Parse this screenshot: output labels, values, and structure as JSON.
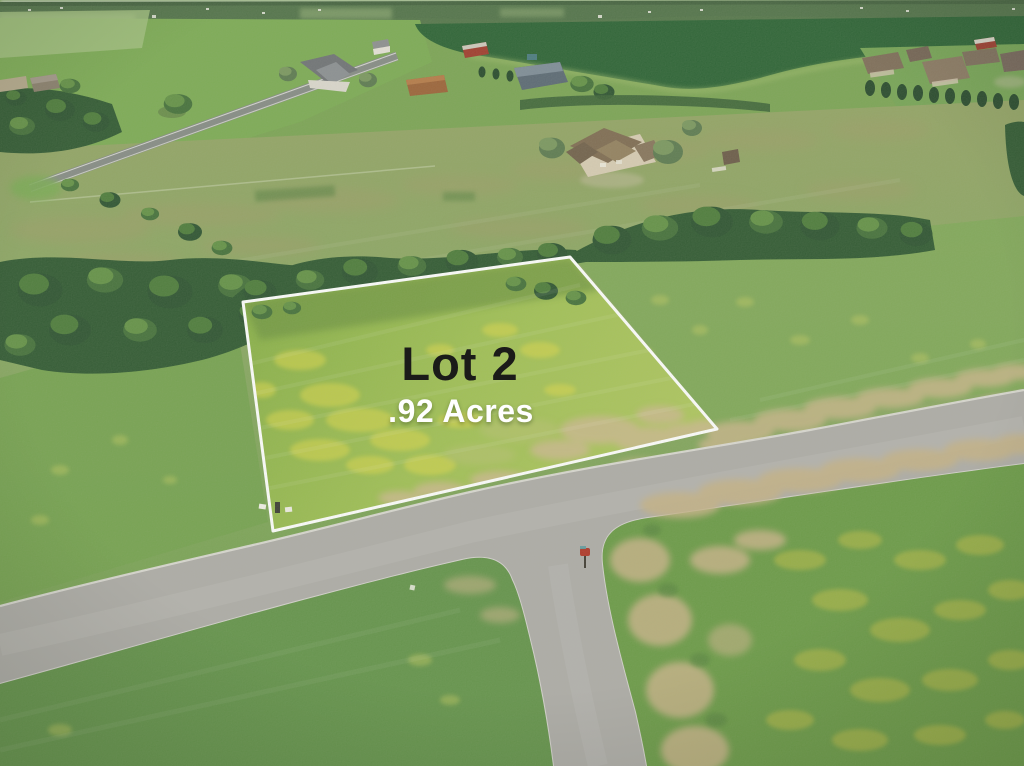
{
  "overlay": {
    "lot_label": "Lot 2",
    "acreage_label": ".92 Acres"
  },
  "colors": {
    "lot_label_text": "#1b1b19",
    "acreage_label_text": "#ffffff",
    "lot_boundary": "#ffffff",
    "lot_grass": "#9cbd4f",
    "pasture_green": "#86a75f",
    "dark_crop_field": "#2b6234",
    "tree_green": "#2f5831",
    "road_gray": "#aeaca8",
    "dirt_tan": "#c7b588",
    "flower_yellow": "#ddd84a",
    "mailbox_red": "#b03527"
  }
}
